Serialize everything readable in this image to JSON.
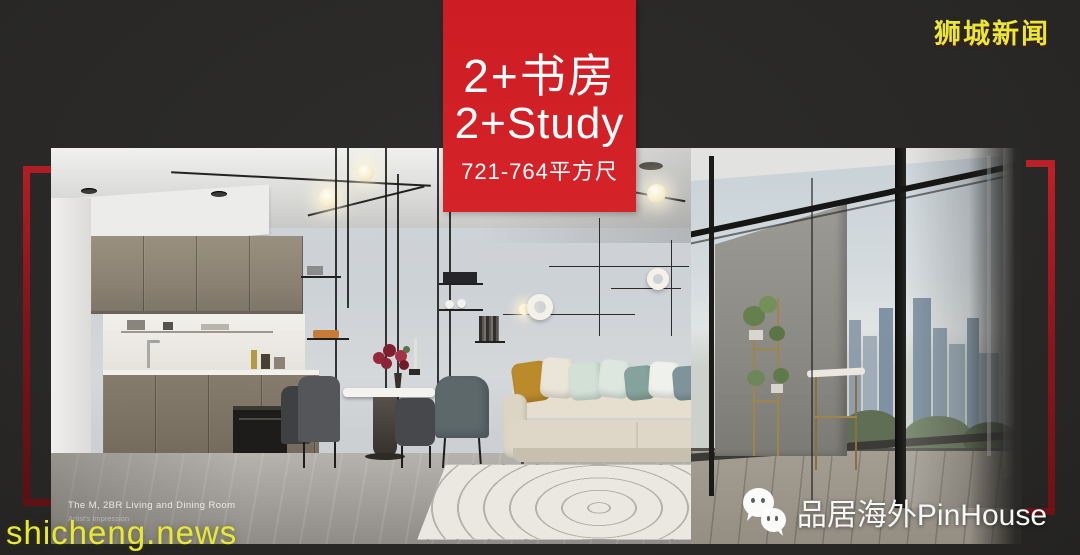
{
  "window": {
    "width": 1080,
    "height": 555,
    "background": "#2b2a28"
  },
  "banner": {
    "unit_type_cn": "2+书房",
    "unit_type_en": "2+Study",
    "floor_area": "721-764平方尺",
    "background_color": "#ce1c24",
    "text_color": "#ffffff"
  },
  "watermarks": {
    "top_right_site": "狮城新闻",
    "bottom_left_site": "shicheng.news",
    "publisher": "品居海外PinHouse",
    "site_color": "#e8e836",
    "publisher_color": "#f7f7f7",
    "publisher_icon": "wechat-bubbles-icon"
  },
  "photo": {
    "caption_title": "The M, 2BR Living and Dining Room",
    "caption_subtitle": "Artist's Impression",
    "subject": "living-dining-room-interior-render"
  },
  "frame": {
    "bracket_color": "#8d161c"
  }
}
